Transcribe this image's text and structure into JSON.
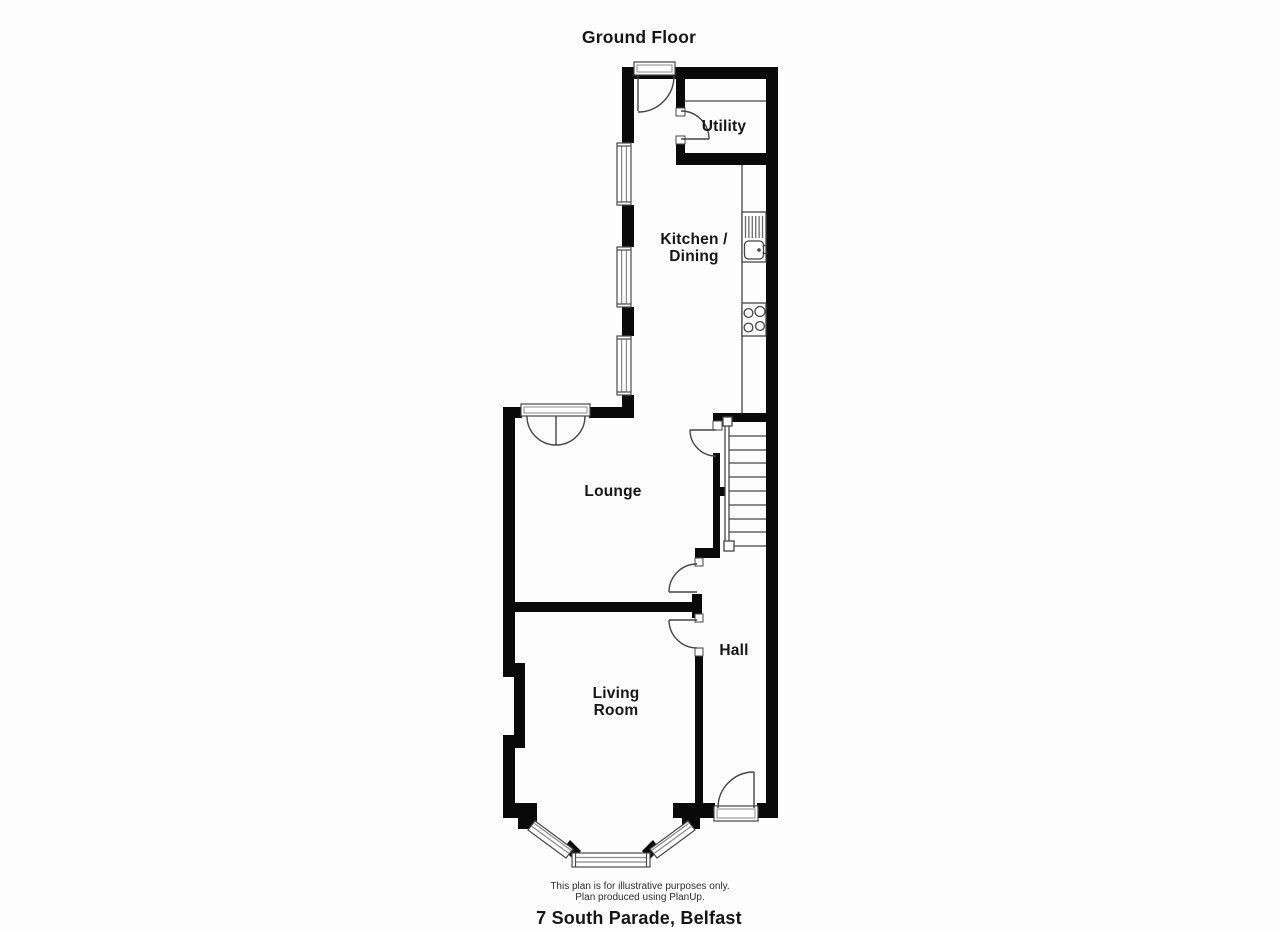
{
  "title": "Ground Floor",
  "rooms": {
    "utility": "Utility",
    "kitchen_line1": "Kitchen /",
    "kitchen_line2": "Dining",
    "lounge": "Lounge",
    "hall": "Hall",
    "living_line1": "Living",
    "living_line2": "Room"
  },
  "footer": {
    "disclaimer_line1": "This plan is for illustrative purposes only.",
    "disclaimer_line2": "Plan produced using PlanUp.",
    "address": "7 South Parade, Belfast"
  },
  "colors": {
    "wall": "#0a0a0a",
    "thin_line": "#454545",
    "background": "#fdfdfd"
  }
}
